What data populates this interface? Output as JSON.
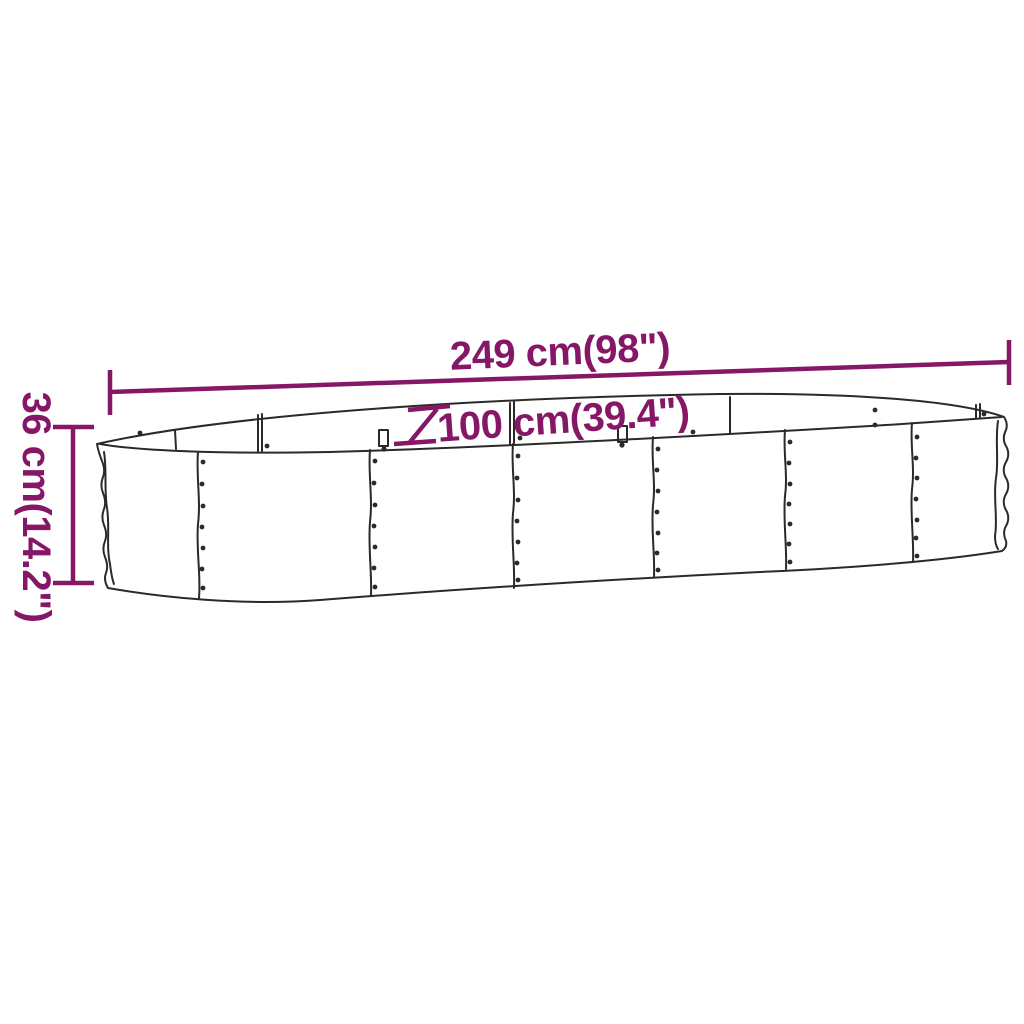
{
  "diagram": {
    "kind": "product-dimension-drawing",
    "object": "oval corrugated metal raised garden bed",
    "dimension_labels": {
      "length": "249 cm(98\")",
      "depth": "100 cm(39.4\")",
      "height": "36 cm(14.2\")"
    },
    "colors": {
      "dimension_accent": "#861766",
      "drawing_outline": "#2a2a2a",
      "background": "#ffffff"
    }
  }
}
